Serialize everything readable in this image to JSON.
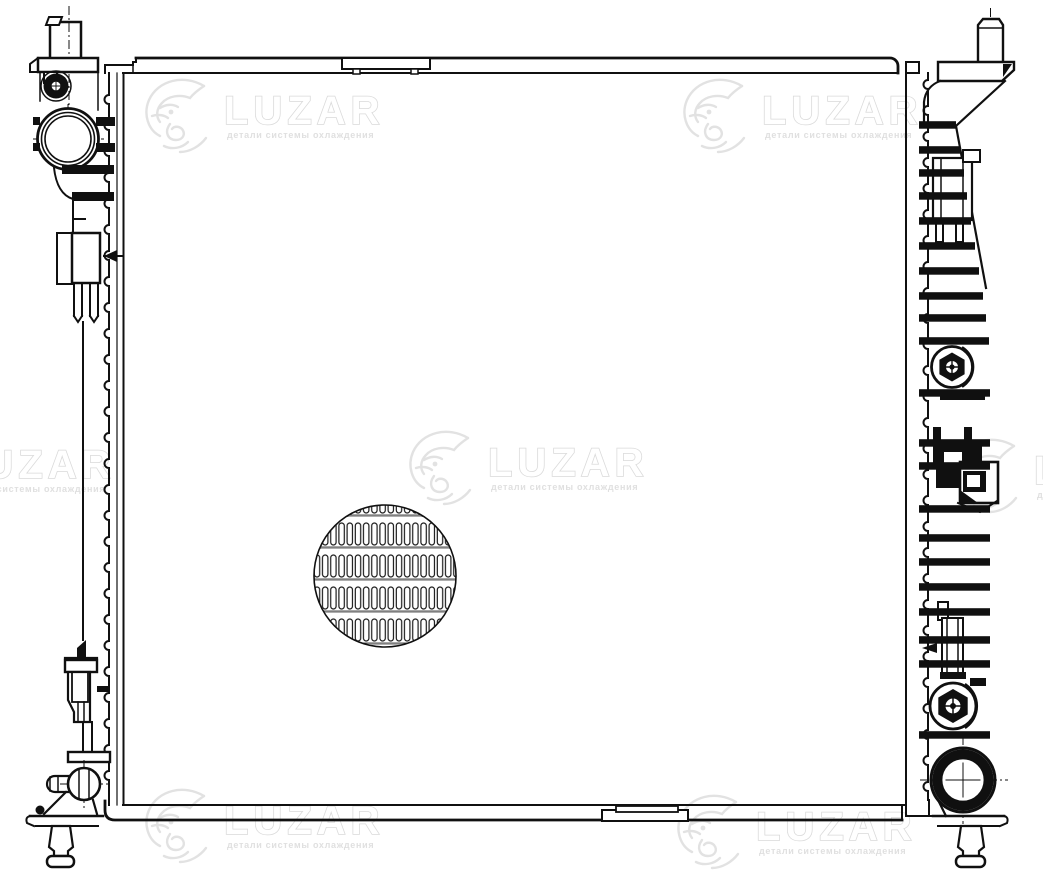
{
  "document": {
    "type": "technical line drawing",
    "subject": "Automotive engine-cooling radiator, front orthographic view with side tanks, fittings and core fin detail",
    "background_color": "#ffffff",
    "line_color": "#101010"
  },
  "watermark": {
    "brand": "LUZAR",
    "tagline": "детали системы охлаждения",
    "color": "#e2e2e2",
    "instances": 7
  },
  "parts": {
    "core": "radiator-core",
    "fin_detail": "core-fin-detail-view",
    "left": [
      "filler-neck",
      "top-left-bracket",
      "bleed-screw",
      "inlet-port",
      "left-side-plate",
      "clamp-bracket",
      "lower-clamp-bracket",
      "drain-valve",
      "left-mounting-foot",
      "left-mounting-pin"
    ],
    "right": [
      "top-mounting-pin",
      "top-right-bracket",
      "outlet-elbow",
      "right-side-ribs",
      "upper-sensor-boss",
      "wiring-connector",
      "lower-bracket",
      "lower-sensor-boss",
      "outlet-port",
      "right-mounting-foot",
      "right-mounting-pin"
    ]
  }
}
